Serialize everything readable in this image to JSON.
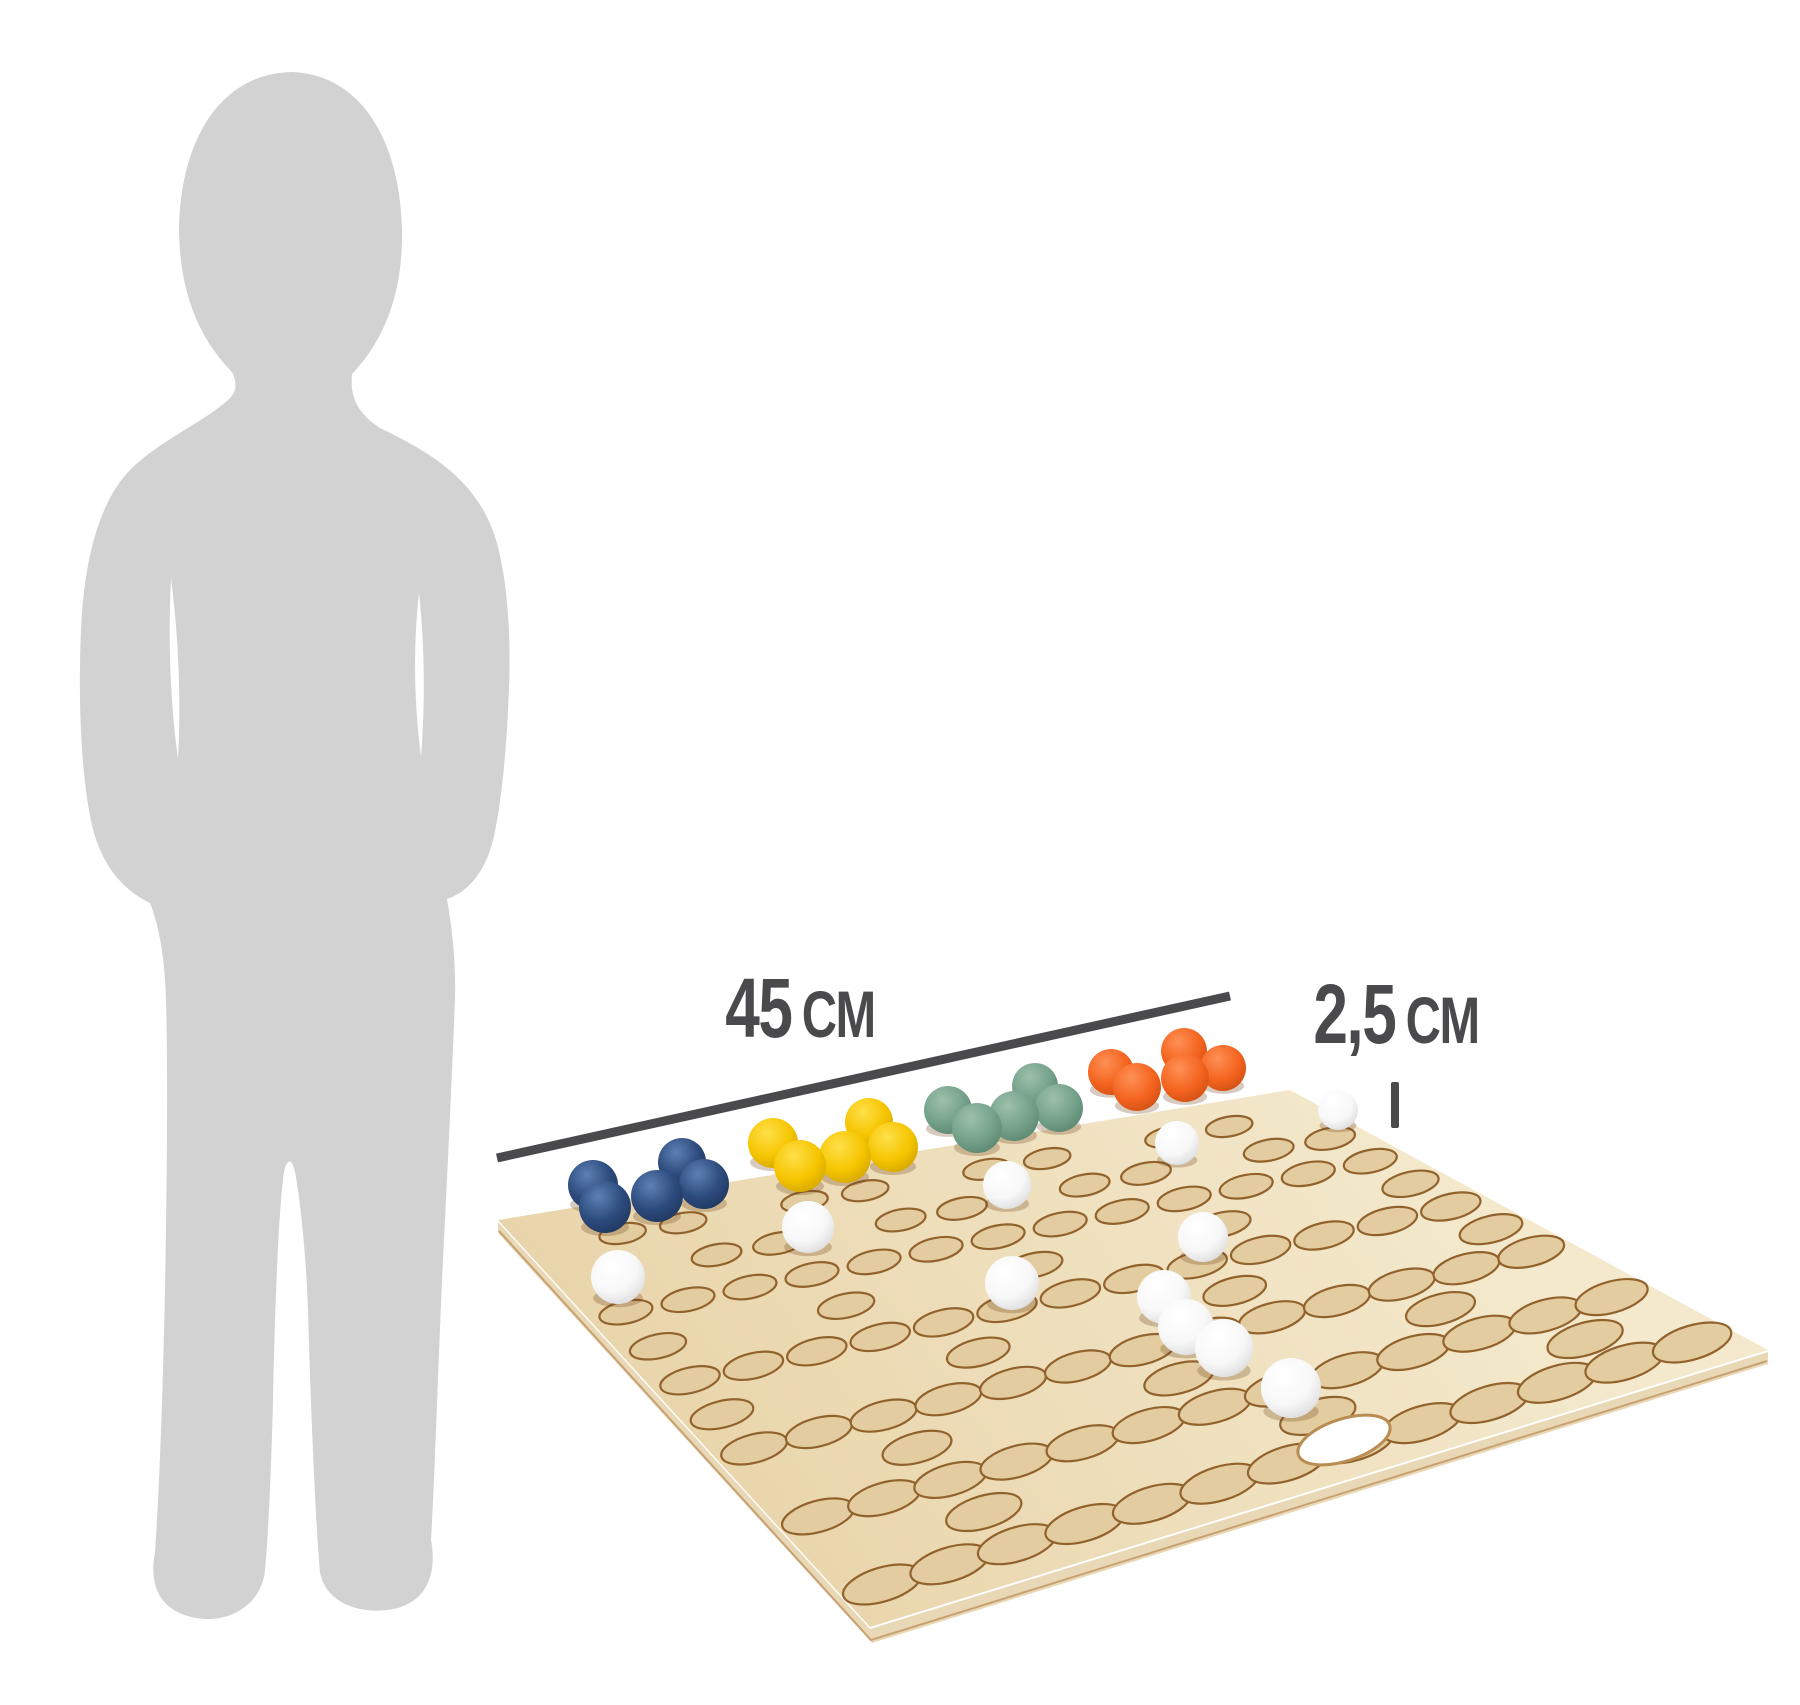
{
  "annotations": {
    "board_width_value": "45",
    "board_width_unit": "CM",
    "hole_size_value": "2,5",
    "hole_size_unit": "CM"
  },
  "scene": {
    "background": "#ffffff",
    "annotation_color": "#4a4a4c",
    "silhouette_color": "#d2d2d3",
    "ball_shadow": "rgba(110,70,30,0.28)",
    "board": {
      "top_color_light": "#f4e9cd",
      "top_color_dark": "#e9d5ab",
      "side_color": "#e9d8b6",
      "side_line_color": "#c8a273",
      "hole_fill": "#e3cda0",
      "hole_rim": "#92622c",
      "corners": {
        "left": [
          498,
          1220
        ],
        "top": [
          1290,
          1090
        ],
        "right": [
          1768,
          1350
        ],
        "bottom": [
          870,
          1627
        ]
      },
      "hole_rows": [
        "0110110110110",
        "0011011011011",
        "1111111111111",
        "1001001001001",
        "1111111111111",
        "1000100010001",
        "1111111111111",
        "0010001000100",
        "1111111111111",
        "0010000100010",
        "1111111111111"
      ],
      "exit_hole": {
        "x": 1344,
        "y": 1440,
        "rx": 48,
        "ry": 21,
        "rotate": -18,
        "fill": "#ffffff",
        "rim": "#b98d52"
      }
    },
    "ball_colors": {
      "blue": {
        "light": "#5c80b4",
        "base": "#2c4a7c",
        "dark": "#1d3257"
      },
      "yellow": {
        "light": "#ffe04a",
        "base": "#f6c500",
        "dark": "#c99d00"
      },
      "green": {
        "light": "#9dc0ab",
        "base": "#74a18a",
        "dark": "#55806a"
      },
      "orange": {
        "light": "#ff9055",
        "base": "#f4641f",
        "dark": "#c74a10"
      },
      "white": {
        "light": "#ffffff",
        "base": "#f8f8f8",
        "dark": "#d4d4d7"
      }
    },
    "balls": [
      {
        "color": "blue",
        "x": 593,
        "y": 1185,
        "r": 25
      },
      {
        "color": "blue",
        "x": 605,
        "y": 1207,
        "r": 26
      },
      {
        "color": "blue",
        "x": 657,
        "y": 1196,
        "r": 26
      },
      {
        "color": "blue",
        "x": 682,
        "y": 1162,
        "r": 24
      },
      {
        "color": "blue",
        "x": 704,
        "y": 1184,
        "r": 25
      },
      {
        "color": "yellow",
        "x": 773,
        "y": 1143,
        "r": 25
      },
      {
        "color": "yellow",
        "x": 800,
        "y": 1166,
        "r": 26
      },
      {
        "color": "yellow",
        "x": 845,
        "y": 1157,
        "r": 26
      },
      {
        "color": "yellow",
        "x": 869,
        "y": 1122,
        "r": 24
      },
      {
        "color": "yellow",
        "x": 893,
        "y": 1147,
        "r": 25
      },
      {
        "color": "green",
        "x": 948,
        "y": 1110,
        "r": 24
      },
      {
        "color": "green",
        "x": 977,
        "y": 1128,
        "r": 25
      },
      {
        "color": "green",
        "x": 1014,
        "y": 1116,
        "r": 25
      },
      {
        "color": "green",
        "x": 1035,
        "y": 1086,
        "r": 23
      },
      {
        "color": "green",
        "x": 1059,
        "y": 1108,
        "r": 24
      },
      {
        "color": "orange",
        "x": 1111,
        "y": 1072,
        "r": 23
      },
      {
        "color": "orange",
        "x": 1137,
        "y": 1087,
        "r": 24
      },
      {
        "color": "orange",
        "x": 1184,
        "y": 1051,
        "r": 23
      },
      {
        "color": "orange",
        "x": 1185,
        "y": 1078,
        "r": 24
      },
      {
        "color": "orange",
        "x": 1223,
        "y": 1068,
        "r": 23
      },
      {
        "color": "white",
        "x": 618,
        "y": 1277,
        "r": 27
      },
      {
        "color": "white",
        "x": 808,
        "y": 1227,
        "r": 26
      },
      {
        "color": "white",
        "x": 1007,
        "y": 1185,
        "r": 24
      },
      {
        "color": "white",
        "x": 1012,
        "y": 1283,
        "r": 27
      },
      {
        "color": "white",
        "x": 1177,
        "y": 1143,
        "r": 22
      },
      {
        "color": "white",
        "x": 1338,
        "y": 1110,
        "r": 20
      },
      {
        "color": "white",
        "x": 1203,
        "y": 1237,
        "r": 25
      },
      {
        "color": "white",
        "x": 1164,
        "y": 1297,
        "r": 27
      },
      {
        "color": "white",
        "x": 1186,
        "y": 1327,
        "r": 28
      },
      {
        "color": "white",
        "x": 1224,
        "y": 1348,
        "r": 29
      },
      {
        "color": "white",
        "x": 1291,
        "y": 1388,
        "r": 30
      }
    ]
  }
}
